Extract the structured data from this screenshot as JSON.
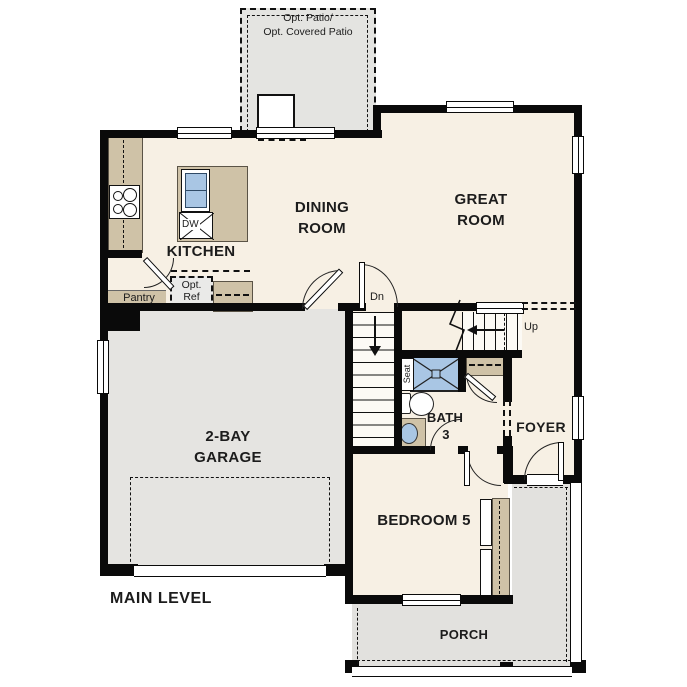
{
  "title": "MAIN LEVEL",
  "rooms": {
    "patio_line1": "Opt. Patio/",
    "patio_line2": "Opt. Covered Patio",
    "kitchen": "KITCHEN",
    "dining_line1": "DINING",
    "dining_line2": "ROOM",
    "great_line1": "GREAT",
    "great_line2": "ROOM",
    "pantry": "Pantry",
    "garage_line1": "2-BAY",
    "garage_line2": "GARAGE",
    "bath_line1": "BATH",
    "bath_line2": "3",
    "foyer": "FOYER",
    "bedroom": "BEDROOM 5",
    "porch": "PORCH"
  },
  "annotations": {
    "stairs_down": "Dn",
    "stairs_up": "Up",
    "seat": "Seat",
    "dishwasher": "DW",
    "opt_ref_line1": "Opt.",
    "opt_ref_line2": "Ref"
  },
  "colors": {
    "wall": "#0a0a0a",
    "floor": "#f7f0e4",
    "garage_floor": "#e5e4e1",
    "porch_floor": "#e2e1de",
    "counter_tan": "#cfc2a7",
    "fixture_blue": "#a9c6e4",
    "background": "#ffffff"
  }
}
